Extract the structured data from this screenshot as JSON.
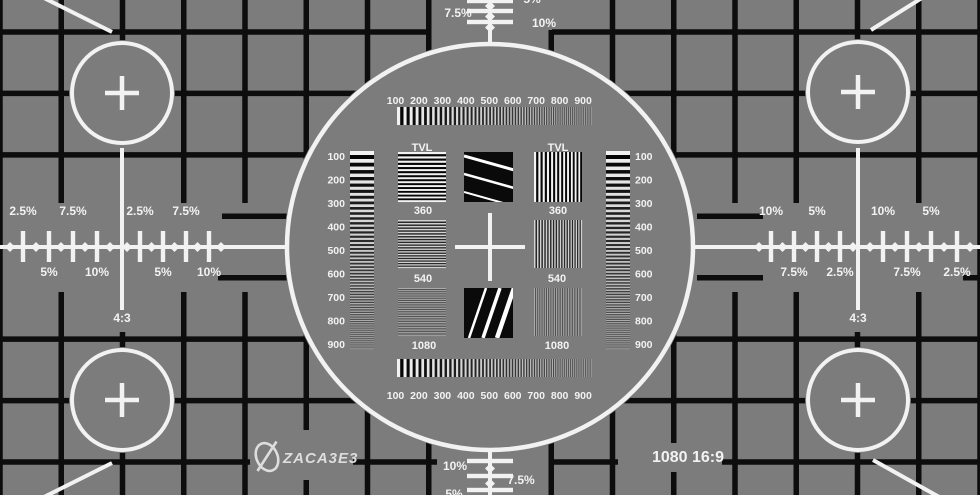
{
  "colors": {
    "background": "#7c7c7c",
    "grid_line": "#0d0d0d",
    "marking": "#f2f2f2",
    "square": "#0a0a0a",
    "logo": "#dddddd"
  },
  "format_label": "1080 16:9",
  "branding": {
    "logo_text": "ZACA3E3",
    "logo_icon": "quill-ellipse-icon"
  },
  "aspect_markers": {
    "left": "4:3",
    "right": "4:3"
  },
  "resolution_scales": {
    "top": [
      "100",
      "200",
      "300",
      "400",
      "500",
      "600",
      "700",
      "800",
      "900"
    ],
    "bottom": [
      "100",
      "200",
      "300",
      "400",
      "500",
      "600",
      "700",
      "800",
      "900"
    ],
    "left": [
      "100",
      "200",
      "300",
      "400",
      "500",
      "600",
      "700",
      "800",
      "900"
    ],
    "right": [
      "100",
      "200",
      "300",
      "400",
      "500",
      "600",
      "700",
      "800",
      "900"
    ]
  },
  "tvl_wedges": {
    "left": {
      "title": "TVL",
      "blocks": [
        "360",
        "540",
        "1080"
      ],
      "orientation": "horizontal-lines"
    },
    "right": {
      "title": "TVL",
      "blocks": [
        "360",
        "540",
        "1080"
      ],
      "orientation": "vertical-lines"
    }
  },
  "overscan_percent": {
    "left_above": [
      "2.5%",
      "7.5%",
      "2.5%",
      "7.5%"
    ],
    "left_below": [
      "5%",
      "10%",
      "5%",
      "10%"
    ],
    "right_above": [
      "10%",
      "5%",
      "10%",
      "5%"
    ],
    "right_below": [
      "7.5%",
      "2.5%",
      "7.5%",
      "2.5%"
    ],
    "top": [
      "5%",
      "7.5%",
      "10%"
    ],
    "bottom": [
      "10%",
      "7.5%",
      "5%"
    ]
  }
}
